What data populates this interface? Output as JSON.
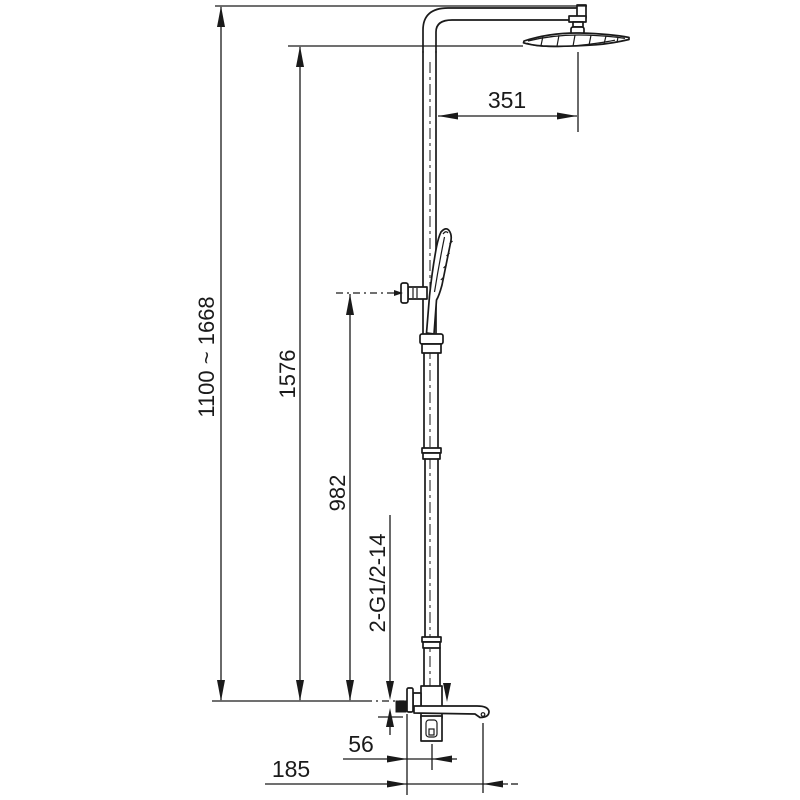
{
  "drawing": {
    "type": "shower-system-dimension-drawing",
    "background": "#ffffff",
    "line_color": "#1a1a1a"
  },
  "labels": {
    "arm_reach": "351",
    "overall_height": "1100 ~ 1668",
    "column_height": "1576",
    "hand_shower_height": "982",
    "connection_thread": "2-G1/2-14",
    "valve_to_spout": "56",
    "spout_reach": "185"
  }
}
